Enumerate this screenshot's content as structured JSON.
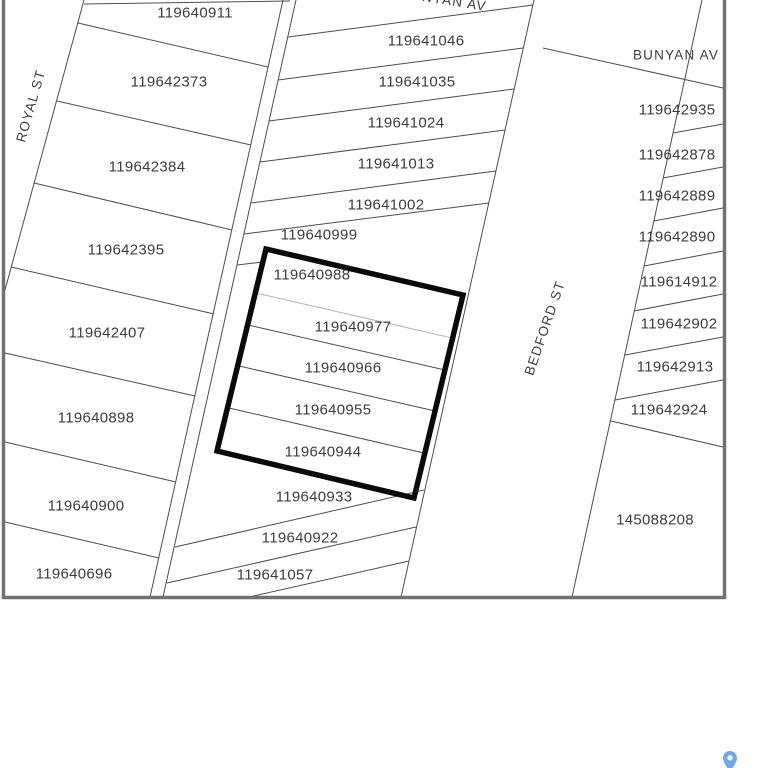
{
  "map": {
    "description": "cadastral parcel map",
    "colors": {
      "line": "#4d4d4d",
      "faint_line": "#b5b5b5",
      "label": "#3c3c3c",
      "frame": "#717171",
      "selection_outline": "#0a0a0a",
      "pin_fill": "#72aadd",
      "background": "#ffffff"
    },
    "street_labels": [
      {
        "text": "ROYAL ST",
        "x": 31,
        "y": 106,
        "rot": -74
      },
      {
        "text": "BUNYAN AV",
        "x": 444,
        "y": 0,
        "rot": 9
      },
      {
        "text": "BUNYAN AV",
        "x": 676,
        "y": 55,
        "rot": 0
      },
      {
        "text": "BEDFORD ST",
        "x": 545,
        "y": 328,
        "rot": -71
      }
    ],
    "parcel_labels": [
      {
        "id": "119640911",
        "x": 195,
        "y": 13
      },
      {
        "id": "119642373",
        "x": 169,
        "y": 82
      },
      {
        "id": "119642384",
        "x": 147,
        "y": 167
      },
      {
        "id": "119642395",
        "x": 126,
        "y": 250
      },
      {
        "id": "119642407",
        "x": 107,
        "y": 333
      },
      {
        "id": "119640898",
        "x": 96,
        "y": 418
      },
      {
        "id": "119640900",
        "x": 86,
        "y": 506
      },
      {
        "id": "119640696",
        "x": 74,
        "y": 574
      },
      {
        "id": "119641046",
        "x": 426,
        "y": 41
      },
      {
        "id": "119641035",
        "x": 417,
        "y": 82
      },
      {
        "id": "119641024",
        "x": 406,
        "y": 123
      },
      {
        "id": "119641013",
        "x": 396,
        "y": 164
      },
      {
        "id": "119641002",
        "x": 386,
        "y": 205
      },
      {
        "id": "119640999",
        "x": 319,
        "y": 235
      },
      {
        "id": "119640988",
        "x": 312,
        "y": 275
      },
      {
        "id": "119640977",
        "x": 353,
        "y": 327
      },
      {
        "id": "119640966",
        "x": 343,
        "y": 368
      },
      {
        "id": "119640955",
        "x": 333,
        "y": 410
      },
      {
        "id": "119640944",
        "x": 323,
        "y": 452
      },
      {
        "id": "119640933",
        "x": 314,
        "y": 497
      },
      {
        "id": "119640922",
        "x": 300,
        "y": 538
      },
      {
        "id": "119641057",
        "x": 275,
        "y": 575
      },
      {
        "id": "119642935",
        "x": 677,
        "y": 110
      },
      {
        "id": "119642878",
        "x": 677,
        "y": 155
      },
      {
        "id": "119642889",
        "x": 677,
        "y": 196
      },
      {
        "id": "119642890",
        "x": 677,
        "y": 237
      },
      {
        "id": "119614912",
        "x": 679,
        "y": 282
      },
      {
        "id": "119642902",
        "x": 679,
        "y": 324
      },
      {
        "id": "119642913",
        "x": 675,
        "y": 367
      },
      {
        "id": "119642924",
        "x": 669,
        "y": 410
      },
      {
        "id": "145088208",
        "x": 655,
        "y": 520
      }
    ],
    "selected_parcel_ids": [
      "119640988",
      "119640977",
      "119640966",
      "119640955",
      "119640944"
    ]
  },
  "marker": {
    "type": "map-pin"
  }
}
